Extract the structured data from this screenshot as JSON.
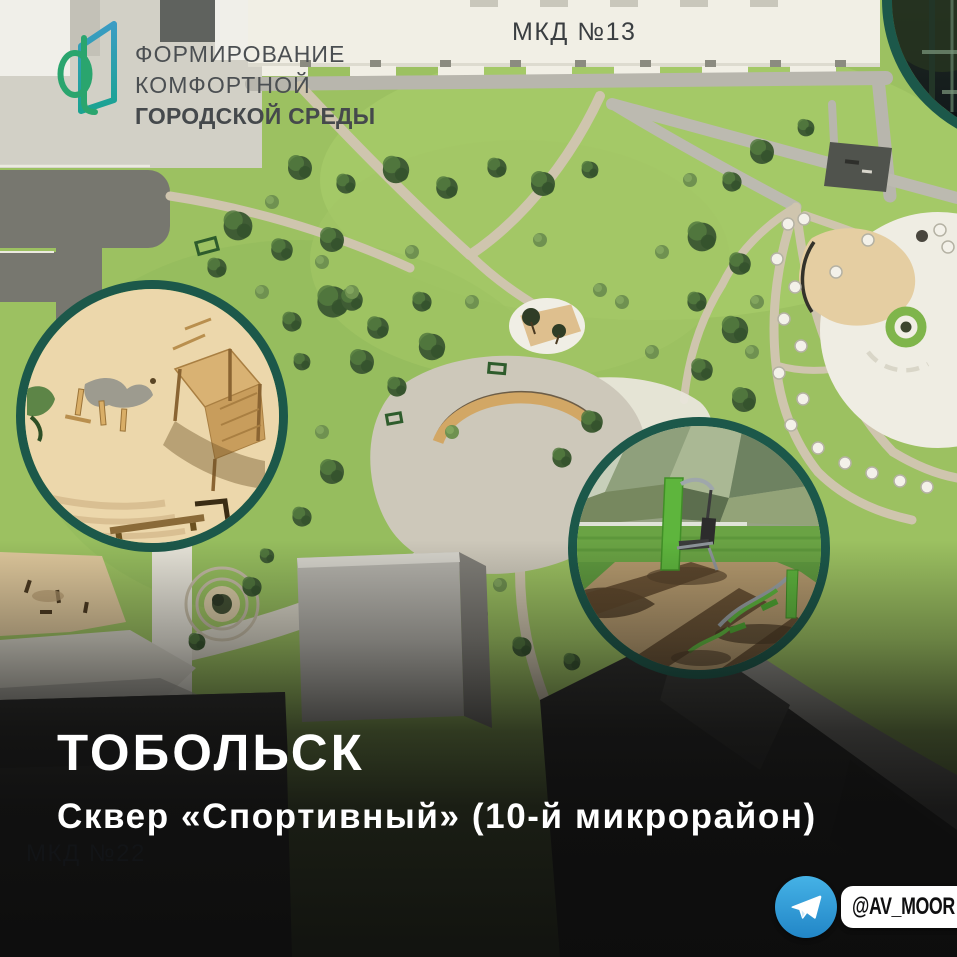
{
  "logo": {
    "icon_name": "fkgs-logo-icon",
    "lines": [
      "ФОРМИРОВАНИЕ",
      "КОМФОРТНОЙ",
      "ГОРОДСКОЙ СРЕДЫ"
    ]
  },
  "plan_labels": {
    "mkd13": "МКД №13",
    "mkd22": "МКД №22"
  },
  "caption": {
    "city": "ТОБОЛЬСК",
    "project": "Сквер «Спортивный» (10-й микрорайон)"
  },
  "badge": {
    "icon_name": "telegram-icon",
    "handle": "@AV_MOOR"
  },
  "insets": {
    "left": "playground-closeup",
    "right": "outdoor-gym-closeup",
    "top_right": "workout-area-closeup"
  },
  "colors": {
    "logo_teal": "#2f9cc0",
    "logo_green": "#2aa56e",
    "inset_border": "#1c584a",
    "telegram_blue": "#2fa3dd",
    "grass": "#9cc161",
    "sand": "#ead6ab",
    "path": "#cfc5ae",
    "title_text": "#ffffff"
  }
}
